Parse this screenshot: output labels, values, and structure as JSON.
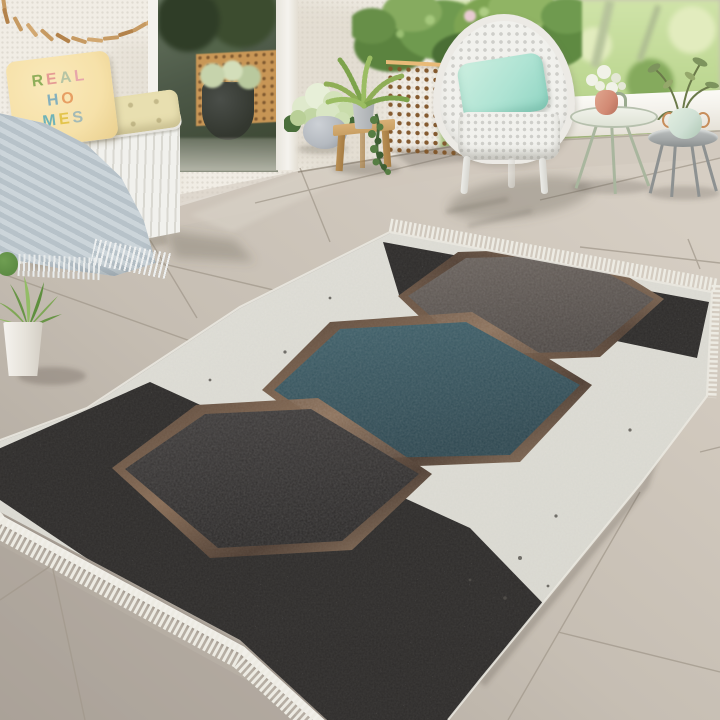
{
  "scene_title": "Patio scene with hexagon-pattern area rug",
  "pillow": {
    "text": "REAL HOMES",
    "lines": [
      [
        {
          "ch": "R",
          "color": "#8fae5a"
        },
        {
          "ch": "E",
          "color": "#e59b94"
        },
        {
          "ch": "A",
          "color": "#b5c4a4"
        },
        {
          "ch": "L",
          "color": "#e7a6aa"
        }
      ],
      [
        {
          "ch": "H",
          "color": "#84b0bd"
        },
        {
          "ch": "O",
          "color": "#e79f63"
        }
      ],
      [
        {
          "ch": "M",
          "color": "#6fb3b8"
        },
        {
          "ch": "E",
          "color": "#e3c44c"
        },
        {
          "ch": "S",
          "color": "#a4bab6"
        }
      ]
    ]
  },
  "palette": {
    "wall": "#f1ede5",
    "wall-shadow": "#d8d1c3",
    "garden-base": "#bdd792",
    "garden-light": "#e2ecbe",
    "garden-dark": "#85aa5d",
    "curb": "#f4f2ec",
    "floor-base": "#c6beb3",
    "floor-light": "#d6cec3",
    "floor-dark": "#aaa298",
    "grout": "#a2998c",
    "door-frame": "#f5f3ee",
    "lattice-wood": "#d39c58",
    "lattice-hole": "#845a2f",
    "wicker-white": "#f1f1ed",
    "wicker-shade": "#d9d8d1",
    "bench-cushion": "#e8dfb0",
    "pillow-bg": "#f6e1a9",
    "blanket": "#c3cdd3",
    "driftwood": "#c69a62",
    "mint-cushion": "#aee3d3",
    "table-sage": "#a9b69e",
    "vase-pink": "#d28a74",
    "vase-celadon": "#cfe0d4",
    "metal-gray": "#a3a7a7",
    "pot-gray": "#b5bac0",
    "wood-stool": "#c89f63",
    "rug-field": "#dcdbd3",
    "rug-fringe": "#edebe3",
    "checker-dark": "#2e2c2b",
    "checker-light": "#d8d5ca",
    "bronze-light": "#a0846a",
    "bronze-dark": "#544236",
    "hex-brown": "#5b5450",
    "hex-teal": "#2e4d57",
    "hex-charcoal": "#312f2f"
  }
}
